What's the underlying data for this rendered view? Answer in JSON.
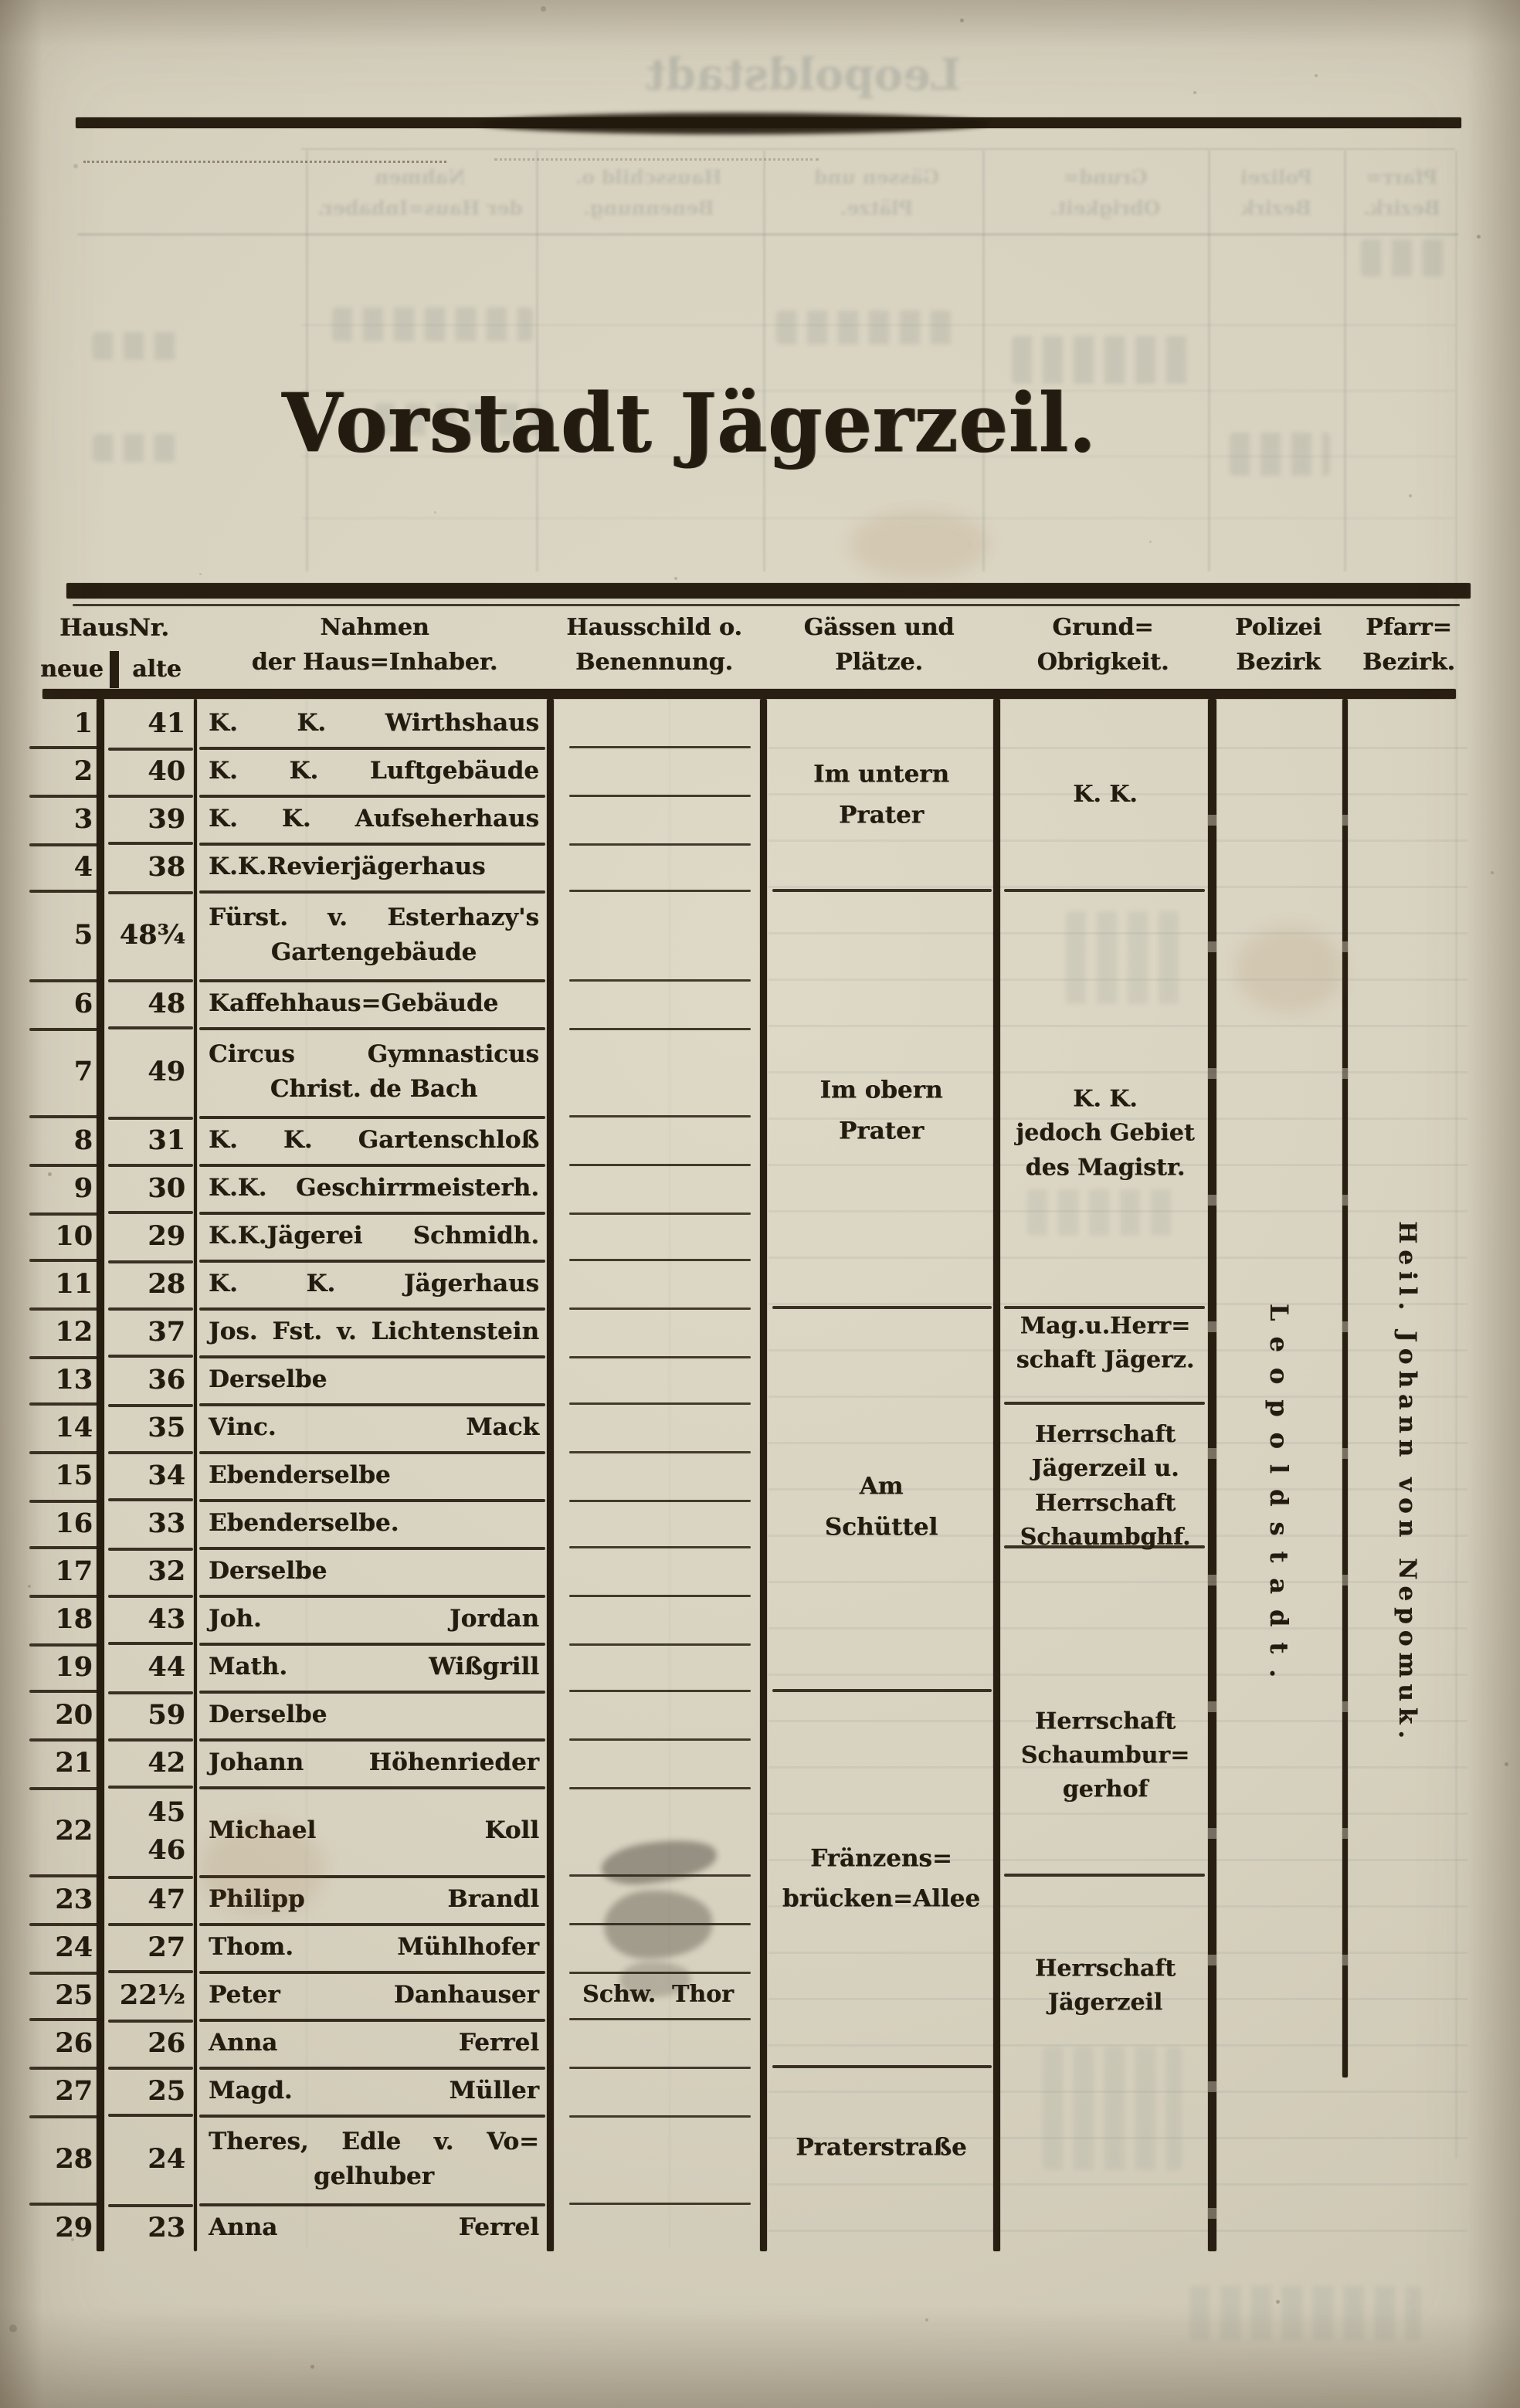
{
  "page": {
    "title": "Vorstadt Jägerzeil."
  },
  "table": {
    "header": {
      "hausnr": "HausNr.",
      "neue": "neue",
      "alte": "alte",
      "nahmen": "Nahmen\nder Haus=Inhaber.",
      "hausschild": "Hausschild o.\nBenennung.",
      "gaessen": "Gässen und\nPlätze.",
      "grund": "Grund=\nObrigkeit.",
      "polizei": "Polizei\nBezirk",
      "pfarr": "Pfarr=\nBezirk."
    },
    "rows": [
      {
        "neu": "1",
        "alt": "41",
        "name": "K. K. Wirthshaus",
        "h": 1
      },
      {
        "neu": "2",
        "alt": "40",
        "name": "K. K. Luftgebäude",
        "h": 1
      },
      {
        "neu": "3",
        "alt": "39",
        "name": "K. K. Aufseherhaus",
        "h": 1
      },
      {
        "neu": "4",
        "alt": "38",
        "name": "K.K.Revierjägerhaus",
        "h": 1
      },
      {
        "neu": "5",
        "alt": "48¾",
        "name": "Fürst. v. Esterhazy's\nGartengebäude",
        "h": 2
      },
      {
        "neu": "6",
        "alt": "48",
        "name": "Kaffehhaus=Gebäude",
        "h": 1
      },
      {
        "neu": "7",
        "alt": "49",
        "name": "Circus Gymnasticus\nChrist. de Bach",
        "h": 2
      },
      {
        "neu": "8",
        "alt": "31",
        "name": "K. K. Gartenschloß",
        "h": 1
      },
      {
        "neu": "9",
        "alt": "30",
        "name": "K.K. Geschirrmeisterh.",
        "h": 1
      },
      {
        "neu": "10",
        "alt": "29",
        "name": "K.K.Jägerei Schmidh.",
        "h": 1
      },
      {
        "neu": "11",
        "alt": "28",
        "name": "K. K. Jägerhaus",
        "h": 1
      },
      {
        "neu": "12",
        "alt": "37",
        "name": "Jos. Fst. v. Lichtenstein",
        "h": 1
      },
      {
        "neu": "13",
        "alt": "36",
        "name": "Derselbe",
        "h": 1
      },
      {
        "neu": "14",
        "alt": "35",
        "name": "Vinc. Mack",
        "h": 1
      },
      {
        "neu": "15",
        "alt": "34",
        "name": "Ebenderselbe",
        "h": 1
      },
      {
        "neu": "16",
        "alt": "33",
        "name": "Ebenderselbe.",
        "h": 1
      },
      {
        "neu": "17",
        "alt": "32",
        "name": "Derselbe",
        "h": 1
      },
      {
        "neu": "18",
        "alt": "43",
        "name": "Joh. Jordan",
        "h": 1
      },
      {
        "neu": "19",
        "alt": "44",
        "name": "Math. Wißgrill",
        "h": 1
      },
      {
        "neu": "20",
        "alt": "59",
        "name": "Derselbe",
        "h": 1
      },
      {
        "neu": "21",
        "alt": "42",
        "name": "Johann Höhenrieder",
        "h": 1
      },
      {
        "neu": "22",
        "alt": "45\n46",
        "name": "Michael Koll",
        "h": 2
      },
      {
        "neu": "23",
        "alt": "47",
        "name": "Philipp Brandl",
        "h": 1
      },
      {
        "neu": "24",
        "alt": "27",
        "name": "Thom. Mühlhofer",
        "h": 1
      },
      {
        "neu": "25",
        "alt": "22½",
        "name": "Peter Danhauser",
        "h": 1,
        "schild": "Schw. Thor"
      },
      {
        "neu": "26",
        "alt": "26",
        "name": "Anna Ferrel",
        "h": 1
      },
      {
        "neu": "27",
        "alt": "25",
        "name": "Magd. Müller",
        "h": 1
      },
      {
        "neu": "28",
        "alt": "24",
        "name": "Theres, Edle v. Vo=\ngelhuber",
        "h": 2
      },
      {
        "neu": "29",
        "alt": "23",
        "name": "Anna Ferrel",
        "h": 1
      }
    ],
    "gaessen_sections": [
      {
        "label": "Im untern\nPrater",
        "from": 1,
        "to": 4
      },
      {
        "label": "Im obern\nPrater",
        "from": 5,
        "to": 11
      },
      {
        "label": "Am\nSchüttel",
        "from": 12,
        "to": 19
      },
      {
        "label": "Fränzens=\nbrücken=Allee",
        "from": 20,
        "to": 26
      },
      {
        "label": "Praterstraße",
        "from": 27,
        "to": 29
      }
    ],
    "grund_sections": [
      {
        "label": "K. K.",
        "from": 1,
        "to": 4
      },
      {
        "label": "K. K.\njedoch Gebiet\ndes Magistr.",
        "from": 5,
        "to": 11
      },
      {
        "label": "Mag.u.Herr=\nschaft Jägerz.",
        "from": 12,
        "to": 13
      },
      {
        "label": "Herrschaft\nJägerzeil u.\nHerrschaft\nSchaumbghf.",
        "from": 14,
        "to": 16
      },
      {
        "label": "Herrschaft\nSchaumbur=\ngerhof",
        "from": 17,
        "to": 22
      },
      {
        "label": "Herrschaft\nJägerzeil",
        "from": 23,
        "to": 29
      }
    ],
    "polizei_bezirk": "Leopoldstadt.",
    "pfarr_bezirk": "Heil. Johann von Nepomuk."
  },
  "show_through": {
    "title": "Leopoldstadt",
    "header_labels": [
      "Nahmen\nder Haus=Inhaber.",
      "Hausschild o.\nBenennung.",
      "Gässen und\nPlätze.",
      "Grund=\nObrigkeit.",
      "Polizei\nBezirk",
      "Pfarr=\nBezirk."
    ]
  },
  "colors": {
    "paper": "#d8d2c0",
    "ink": "#241b10",
    "rule": "#281e12",
    "show_through": "#5f7070"
  }
}
